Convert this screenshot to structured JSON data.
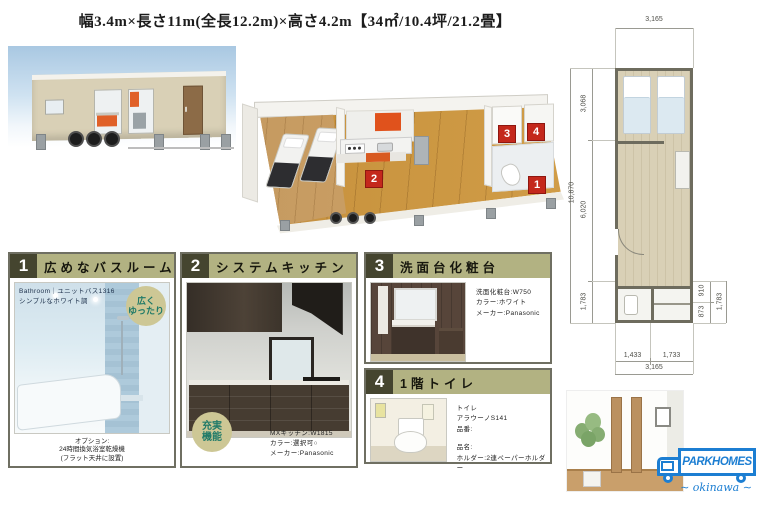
{
  "header": {
    "title": "幅3.4m×長さ11m(全長12.2m)×高さ4.2m【34㎡/10.4坪/21.2畳】"
  },
  "markers": {
    "bath": "1",
    "kitchen": "2",
    "vanity": "3",
    "toilet": "4"
  },
  "panels": [
    {
      "number": "1",
      "title": "広めなバスルーム",
      "overlay_line1": "Bathroom｜ユニットバス1316",
      "overlay_line2": "シンプルなホワイト調",
      "badge_line1": "広く",
      "badge_line2": "ゆったり",
      "footer_lines": [
        "オプション:",
        "24時間換気浴室乾燥機",
        "(フラット天井に設置)"
      ]
    },
    {
      "number": "2",
      "title": "システムキッチン",
      "badge_line1": "充実",
      "badge_line2": "機能",
      "specs": [
        "MXキッチン:W1815",
        "カラー:選択可○",
        "メーカー:Panasonic"
      ]
    },
    {
      "number": "3",
      "title": "洗面台化粧台",
      "specs": [
        "洗面化粧台:W750",
        "カラー:ホワイト",
        "メーカー:Panasonic"
      ]
    },
    {
      "number": "4",
      "title": "1階トイレ",
      "specs": [
        "トイレ",
        "アラウーノS141",
        "品番:",
        "品名:",
        "ホルダー:2連ペーパーホルダー"
      ]
    }
  ],
  "floorplan": {
    "dims": {
      "top": "3,165",
      "left_total": "10,870",
      "left_segments": [
        "3,068",
        "6,020",
        "1,783"
      ],
      "right_segments": [
        "910",
        "873"
      ],
      "right_total": "1,783",
      "bottom_segments": [
        "1,433",
        "1,733"
      ],
      "bottom_total": "3,165"
    }
  },
  "logo": {
    "name": "PARKHOMES",
    "sub": "okinawa"
  },
  "colors": {
    "accent_red": "#c4281c",
    "header_bar": "#b2b282",
    "number_box": "#45452f",
    "logo_blue": "#1c7ed2",
    "badge_bg": "#cdc795",
    "badge_text": "#1f7a68"
  }
}
